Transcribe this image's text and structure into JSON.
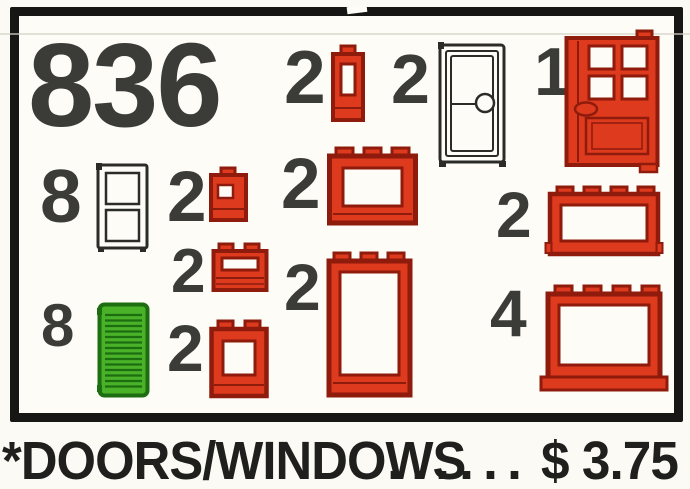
{
  "set": {
    "number": "836",
    "caption": "*DOORS/WINDOWS",
    "dots": "......",
    "price": "$ 3.75"
  },
  "colors": {
    "paper": "#fdfcf7",
    "paper_outer": "#fbfaf4",
    "border": "#161614",
    "ink": "#3b3b38",
    "ink_caption": "#1f1f1d",
    "red": "#dd3a1e",
    "red_dark": "#8f1b0c",
    "green": "#49b228",
    "green_dark": "#1d6e10",
    "crease": "#d6d2c6"
  },
  "items": [
    {
      "qty": "2",
      "piece": "red-window-1x1x2"
    },
    {
      "qty": "2",
      "piece": "white-door"
    },
    {
      "qty": "1",
      "piece": "red-door"
    },
    {
      "qty": "8",
      "piece": "white-window-2pane"
    },
    {
      "qty": "2",
      "piece": "red-window-1x1"
    },
    {
      "qty": "2",
      "piece": "red-window-1x3x2"
    },
    {
      "qty": "2",
      "piece": "red-window-frame-1x4x2"
    },
    {
      "qty": "2",
      "piece": "red-window-1x2x1"
    },
    {
      "qty": "2",
      "piece": "red-door-frame-1x3x4"
    },
    {
      "qty": "8",
      "piece": "green-shutter"
    },
    {
      "qty": "2",
      "piece": "red-window-1x2x2"
    },
    {
      "qty": "4",
      "piece": "red-window-frame-1x4x3"
    }
  ]
}
